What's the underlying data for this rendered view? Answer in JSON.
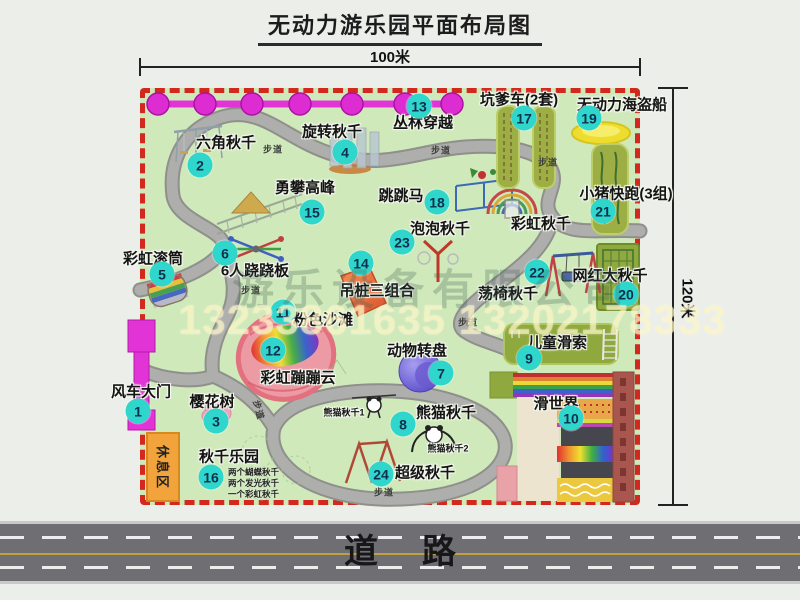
{
  "title": "无动力游乐园平面布局图",
  "dims": {
    "top": "100米",
    "right": "120米"
  },
  "road": {
    "label": "道路"
  },
  "rest_area": "休息区",
  "trail_label": "步道",
  "watermark": {
    "company": "游乐设备有限公司",
    "phone": "13233861635 13202178333"
  },
  "colors": {
    "badge": "#2ed6cc",
    "boundary": "#d3281e",
    "park-green": "#cfe9bb",
    "magenta": "#e233d6",
    "road": "#6e6e73"
  },
  "swing_park_notes": [
    "两个蝴蝶秋千",
    "两个发光秋千",
    "一个彩虹秋千"
  ],
  "map_items": [
    {
      "num": 1,
      "label": "风车大门",
      "lx": 141,
      "ly": 391,
      "bx": 138,
      "by": 411
    },
    {
      "num": 2,
      "label": "六角秋千",
      "lx": 226,
      "ly": 142,
      "bx": 200,
      "by": 165
    },
    {
      "num": 3,
      "label": "樱花树",
      "lx": 212,
      "ly": 401,
      "bx": 216,
      "by": 421
    },
    {
      "num": 4,
      "label": "旋转秋千",
      "lx": 332,
      "ly": 131,
      "bx": 345,
      "by": 152
    },
    {
      "num": 5,
      "label": "彩虹滚筒",
      "lx": 153,
      "ly": 258,
      "bx": 162,
      "by": 274
    },
    {
      "num": 6,
      "label": "6人跷跷板",
      "lx": 255,
      "ly": 270,
      "bx": 225,
      "by": 253
    },
    {
      "num": 7,
      "label": "动物转盘",
      "lx": 417,
      "ly": 350,
      "bx": 441,
      "by": 373
    },
    {
      "num": 8,
      "label": "熊猫秋千",
      "lx": 446,
      "ly": 412,
      "bx": 403,
      "by": 424
    },
    {
      "num": 9,
      "label": "儿童滑索",
      "lx": 557,
      "ly": 342,
      "bx": 529,
      "by": 358
    },
    {
      "num": 10,
      "label": "滑世界",
      "lx": 556,
      "ly": 403,
      "bx": 571,
      "by": 418
    },
    {
      "num": 11,
      "label": "粉色沙滩",
      "lx": 323,
      "ly": 319,
      "bx": 283,
      "by": 312
    },
    {
      "num": 12,
      "label": "彩虹蹦蹦云",
      "lx": 298,
      "ly": 377,
      "bx": 273,
      "by": 350
    },
    {
      "num": 13,
      "label": "丛林穿越",
      "lx": 423,
      "ly": 122,
      "bx": 419,
      "by": 106
    },
    {
      "num": 14,
      "label": "吊桩三组合",
      "lx": 377,
      "ly": 290,
      "bx": 361,
      "by": 263
    },
    {
      "num": 15,
      "label": "勇攀高峰",
      "lx": 305,
      "ly": 187,
      "bx": 312,
      "by": 212
    },
    {
      "num": 16,
      "label": "秋千乐园",
      "lx": 229,
      "ly": 456,
      "bx": 211,
      "by": 477
    },
    {
      "num": 17,
      "label": "坑爹车(2套)",
      "lx": 519,
      "ly": 99,
      "bx": 524,
      "by": 118
    },
    {
      "num": 18,
      "label": "跳跳马",
      "lx": 401,
      "ly": 195,
      "bx": 437,
      "by": 202
    },
    {
      "num": 19,
      "label": "无动力海盗船",
      "lx": 622,
      "ly": 104,
      "bx": 589,
      "by": 118
    },
    {
      "num": 20,
      "label": "网红大秋千",
      "lx": 610,
      "ly": 275,
      "bx": 626,
      "by": 294
    },
    {
      "num": 21,
      "label": "小猪快跑(3组)",
      "lx": 626,
      "ly": 193,
      "bx": 603,
      "by": 211
    },
    {
      "num": 22,
      "label": "荡椅秋千",
      "lx": 508,
      "ly": 293,
      "bx": 537,
      "by": 272
    },
    {
      "num": 23,
      "label": "泡泡秋千",
      "lx": 440,
      "ly": 228,
      "bx": 402,
      "by": 242
    },
    {
      "num": 24,
      "label": "超级秋千",
      "lx": 425,
      "ly": 472,
      "bx": 381,
      "by": 474
    }
  ],
  "extra_labels": [
    {
      "name": "rainbow-swing-label",
      "text": "彩虹秋千",
      "x": 541,
      "y": 223,
      "size": "md"
    },
    {
      "name": "panda-swing-1-label",
      "text": "熊猫秋千1",
      "x": 344,
      "y": 412,
      "size": "sm"
    },
    {
      "name": "panda-swing-2-label",
      "text": "熊猫秋千2",
      "x": 448,
      "y": 448,
      "size": "sm"
    }
  ],
  "trail_positions": [
    {
      "x": 273,
      "y": 149,
      "rot": 0
    },
    {
      "x": 441,
      "y": 150,
      "rot": 0
    },
    {
      "x": 548,
      "y": 162,
      "rot": 0
    },
    {
      "x": 251,
      "y": 290,
      "rot": 0
    },
    {
      "x": 468,
      "y": 322,
      "rot": 0
    },
    {
      "x": 384,
      "y": 492,
      "rot": 0
    },
    {
      "x": 259,
      "y": 410,
      "rot": 75
    }
  ]
}
